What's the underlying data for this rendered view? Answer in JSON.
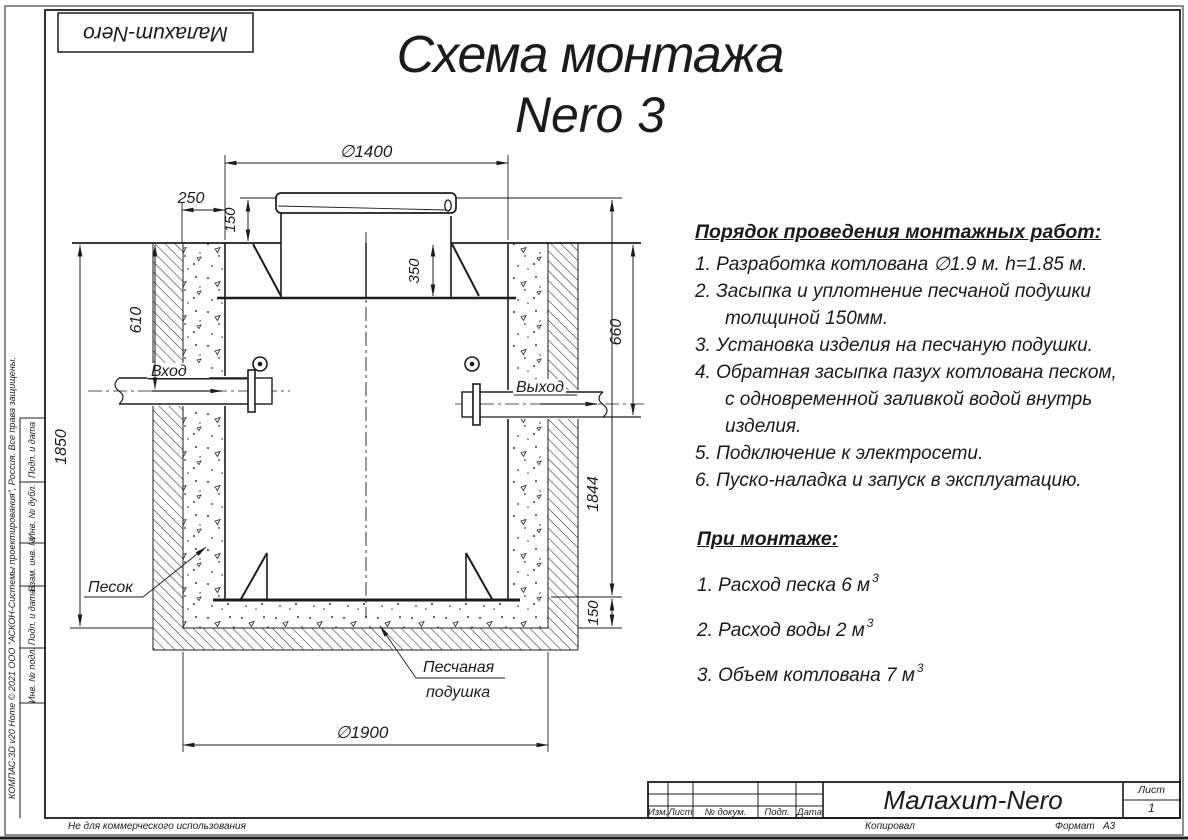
{
  "page": {
    "logo": "Малахит-Nero",
    "title_line1": "Схема монтажа",
    "title_line2": "Nero 3"
  },
  "instructions": {
    "heading": "Порядок проведения монтажных работ:",
    "items": [
      [
        "1. Разработка котлована ∅1.9 м. h=1.85 м."
      ],
      [
        "2. Засыпка и уплотнение песчаной подушки",
        "толщиной 150мм."
      ],
      [
        "3. Установка изделия на песчаную подушки."
      ],
      [
        "4. Обратная засыпка пазух котлована песком,",
        "с одновременной заливкой водой внутрь",
        "изделия."
      ],
      [
        "5. Подключение к электросети."
      ],
      [
        "6. Пуско-наладка и запуск в эксплуатацию."
      ]
    ]
  },
  "montage": {
    "heading": "При монтаже:",
    "items": [
      {
        "text": "1. Расход песка 6 м",
        "sup": "3"
      },
      {
        "text": "2. Расход воды 2 м",
        "sup": "3"
      },
      {
        "text": "3. Объем котлована 7 м",
        "sup": "3"
      }
    ]
  },
  "drawing": {
    "dims": {
      "d1400": "∅1400",
      "d250": "250",
      "d150_top": "150",
      "d350": "350",
      "d610": "610",
      "d1850": "1850",
      "d660": "660",
      "d1844": "1844",
      "d150_bottom": "150",
      "d1900": "∅1900"
    },
    "labels": {
      "inlet": "Вход",
      "outlet": "Выход",
      "sand": "Песок",
      "cushion1": "Песчаная",
      "cushion2": "подушка"
    }
  },
  "titleblock": {
    "col_izm": "Изм.",
    "col_list": "Лист",
    "col_doc": "№ докум.",
    "col_podp": "Подп.",
    "col_data": "Дата",
    "company": "Малахит-Nero",
    "sheet_label": "Лист",
    "sheet_number": "1",
    "kopiroval": "Копировал",
    "format_label": "Формат",
    "format_value": "А3"
  },
  "sidebar": {
    "cells": [
      "Подп. и дата",
      "Инв. № дубл.",
      "Взам. инв. №",
      "Подп. и дата",
      "Инв. № подл."
    ],
    "watermark": "КОМПАС-3D v20 Home © 2021 ООО \"АСКОН-Системы проектирования\", Россия. Все права защищены.",
    "footer_note": "Не для коммерческого использования"
  }
}
